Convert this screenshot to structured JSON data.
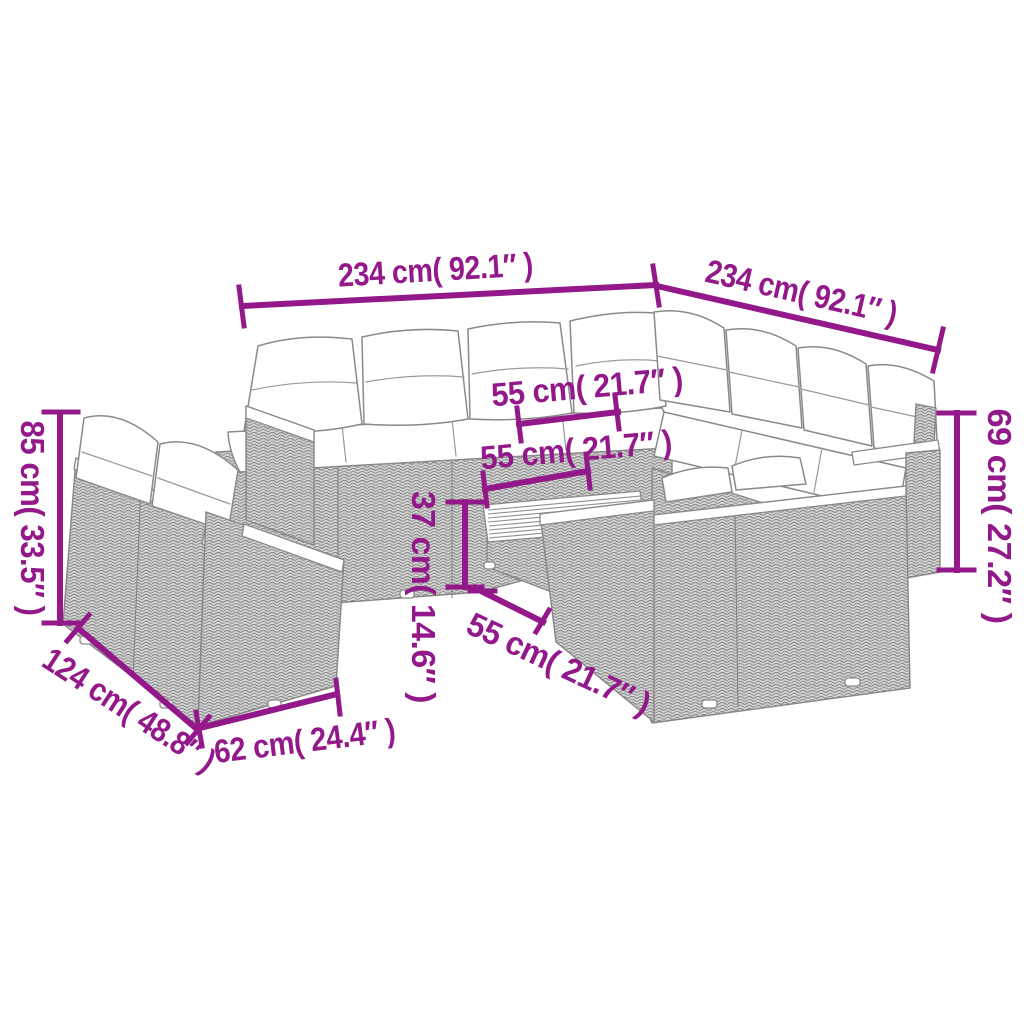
{
  "page": {
    "background": "#ffffff",
    "type": "product-dimension-diagram",
    "subject": "rattan garden lounge set with cushions and wood-top table"
  },
  "style": {
    "accent_color": "#93198B",
    "line_art_color": "#8a8a8a"
  },
  "dimensions": {
    "left_sofa_run_width": "234 cm( 92.1″ )",
    "right_sofa_run_width": "234 cm( 92.1″ )",
    "backrest_height": "85 cm( 33.5″ )",
    "armrest_height": "69 cm( 27.2″ )",
    "seat_depth": "55 cm( 21.7″ )",
    "table_top_width": "55 cm( 21.7″ )",
    "table_height": "37 cm( 14.6″ )",
    "table_top_depth": "55 cm( 21.7″ )",
    "single_sofa_depth": "124 cm( 48.8″ )",
    "single_sofa_width": "62 cm( 24.4″ )"
  }
}
